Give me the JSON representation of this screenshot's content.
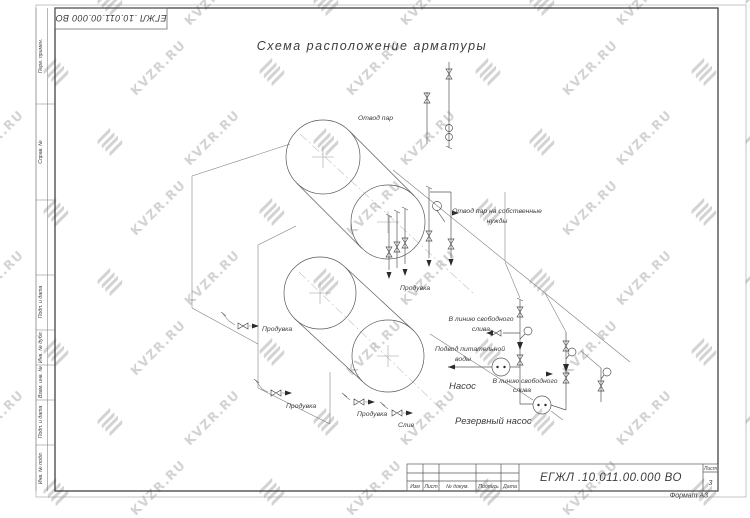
{
  "watermark": {
    "text": "KVZR.RU",
    "color": "#c9c9c9"
  },
  "drawing": {
    "title": "Схема расположение арматуры",
    "designation": "ЕГЖЛ .10.011.00.000   ВО",
    "designation_top": "ЕГЖЛ .10.011.00.000   ВО",
    "format_label": "Формат А3",
    "sheet_label": "Лист",
    "sheet_number": "3",
    "labels": {
      "steam_out": "Отвод пар",
      "steam_own_needs_1": "Отвод пар на собственные",
      "steam_own_needs_2": "нужды",
      "blowdown_center": "Продувка",
      "blowdown_left": "Продувка",
      "blowdown_bottom1": "Продувка",
      "blowdown_bottom2": "Продувка",
      "drain": "Слив",
      "free_drain_1a": "В линию свободного",
      "free_drain_1b": "слива",
      "free_drain_2a": "В линию свободного",
      "free_drain_2b": "слива",
      "feedwater_1": "Подвод питательной",
      "feedwater_2": "воды",
      "pump": "Насос",
      "reserve_pump": "Резервный насос"
    },
    "titleblock": {
      "col_izm": "Изм",
      "col_list": "Лист",
      "col_ndocum": "№ докум.",
      "col_podpis": "Подпись",
      "col_data": "Дата"
    },
    "side_labels": [
      "Перв. примен.",
      "Справ. №",
      "Подп. и дата",
      "Инв. № дубл.",
      "Взам. инв. №",
      "Подп. и дата",
      "Инв. № подл."
    ]
  }
}
